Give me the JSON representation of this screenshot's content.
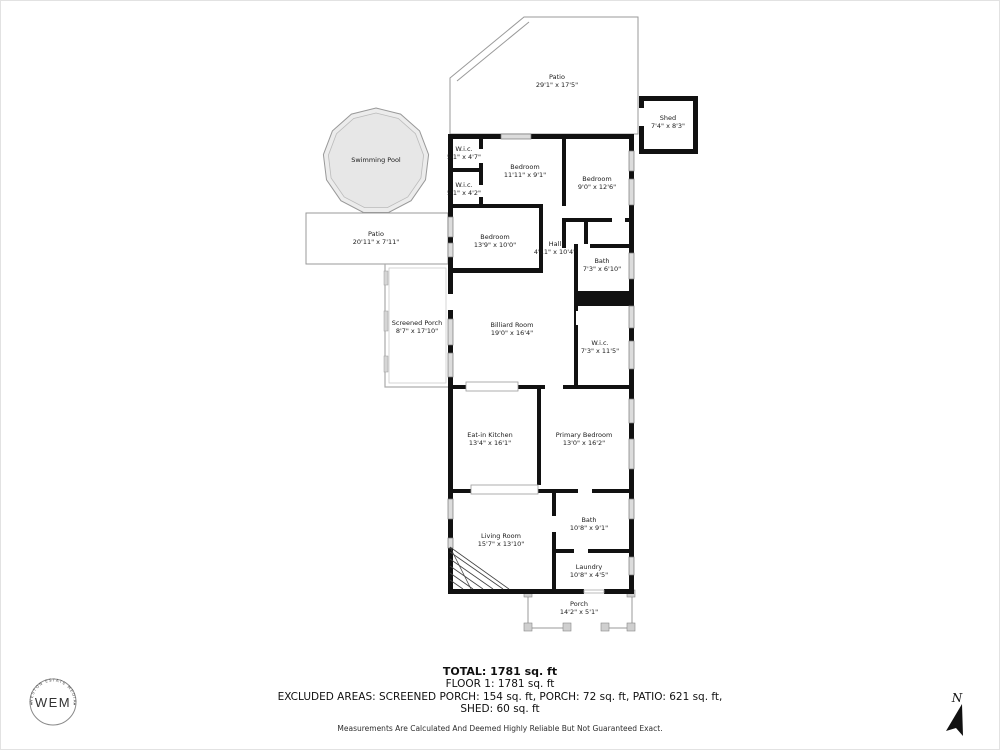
{
  "plan": {
    "rooms": [
      {
        "name": "Patio",
        "dims": "29'1\" x 17'5\""
      },
      {
        "name": "Shed",
        "dims": "7'4\" x 8'3\""
      },
      {
        "name": "Swimming Pool"
      },
      {
        "name": "Patio",
        "dims": "20'11\" x 7'11\""
      },
      {
        "name": "W.i.c.",
        "dims": "5'1\" x 4'7\""
      },
      {
        "name": "Bedroom",
        "dims": "11'11\" x 9'1\""
      },
      {
        "name": "Bedroom",
        "dims": "9'0\" x 12'6\""
      },
      {
        "name": "W.i.c.",
        "dims": "5'1\" x 4'2\""
      },
      {
        "name": "Bedroom",
        "dims": "13'9\" x 10'0\""
      },
      {
        "name": "Hall",
        "dims": "4'11\" x 10'4\""
      },
      {
        "name": "Bath",
        "dims": "7'3\" x 6'10\""
      },
      {
        "name": "Screened Porch",
        "dims": "8'7\" x 17'10\""
      },
      {
        "name": "Billiard Room",
        "dims": "19'0\" x 16'4\""
      },
      {
        "name": "W.i.c.",
        "dims": "7'3\" x 11'5\""
      },
      {
        "name": "Eat-in Kitchen",
        "dims": "13'4\" x 16'1\""
      },
      {
        "name": "Primary Bedroom",
        "dims": "13'0\" x 16'2\""
      },
      {
        "name": "Living Room",
        "dims": "15'7\" x 13'10\""
      },
      {
        "name": "Bath",
        "dims": "10'8\" x 9'1\""
      },
      {
        "name": "Laundry",
        "dims": "10'8\" x 4'5\""
      },
      {
        "name": "Porch",
        "dims": "14'2\" x 5'1\""
      }
    ]
  },
  "summary": {
    "total": "TOTAL: 1781 sq. ft",
    "floor1": "FLOOR 1: 1781 sq. ft",
    "excluded_line1": "EXCLUDED AREAS: SCREENED PORCH: 154 sq. ft, PORCH: 72 sq. ft, PATIO: 621 sq. ft,",
    "excluded_line2": "SHED: 60 sq. ft",
    "disclaimer": "Measurements Are Calculated And Deemed Highly Reliable But Not Guaranteed Exact."
  },
  "compass": {
    "north_label": "N"
  },
  "logo": {
    "initials": "WEM",
    "arc_text": "WESTON ESTATE MEDIA"
  },
  "colors": {
    "wall": "#111111",
    "outline": "#999999",
    "pool_fill": "#ececec",
    "window_fill": "#dcdcdc"
  }
}
